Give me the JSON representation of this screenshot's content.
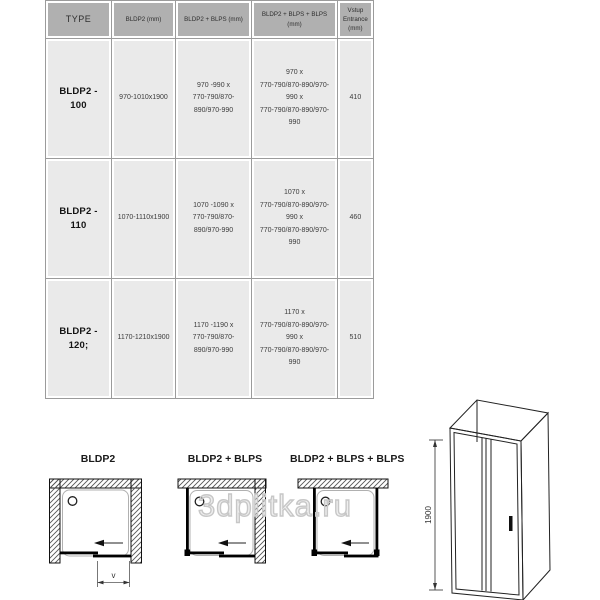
{
  "watermark": "3dplitka.ru",
  "table": {
    "headers": [
      "TYPE",
      "BLDP2 (mm)",
      "BLDP2 + BLPS (mm)",
      "BLDP2 + BLPS + BLPS (mm)",
      "Vstup\nEntrance\n(mm)"
    ],
    "rows": [
      {
        "type": "BLDP2 - 100",
        "bldp2": "970-1010x1900",
        "bldp2_blps": "970 -990 x\n770-790/870-890/970-990",
        "bldp2_blps_blps": "970 x\n770-790/870-890/970-990 x\n770-790/870-890/970-990",
        "entrance": "410"
      },
      {
        "type": "BLDP2 - 110",
        "bldp2": "1070-1110x1900",
        "bldp2_blps": "1070 -1090 x\n770-790/870-890/970-990",
        "bldp2_blps_blps": "1070 x\n770-790/870-890/970-990 x\n770-790/870-890/970-990",
        "entrance": "460"
      },
      {
        "type": "BLDP2 - 120;",
        "bldp2": "1170-1210x1900",
        "bldp2_blps": "1170 -1190 x\n770-790/870-890/970-990",
        "bldp2_blps_blps": "1170 x\n770-790/870-890/970-990 x\n770-790/870-890/970-990",
        "entrance": "510"
      }
    ]
  },
  "diagrams": {
    "plan1_label": "BLDP2",
    "plan2_label": "BLDP2 + BLPS",
    "plan3_label": "BLDP2 + BLPS + BLPS",
    "entrance_dim_label": "v",
    "height_dim_label": "1900"
  },
  "colors": {
    "header_bg": "#b0b0b0",
    "row_bg": "#eaeaea",
    "grid_line": "#9b9b9b",
    "hatch_line": "#555555",
    "drawing_line": "#222222"
  }
}
